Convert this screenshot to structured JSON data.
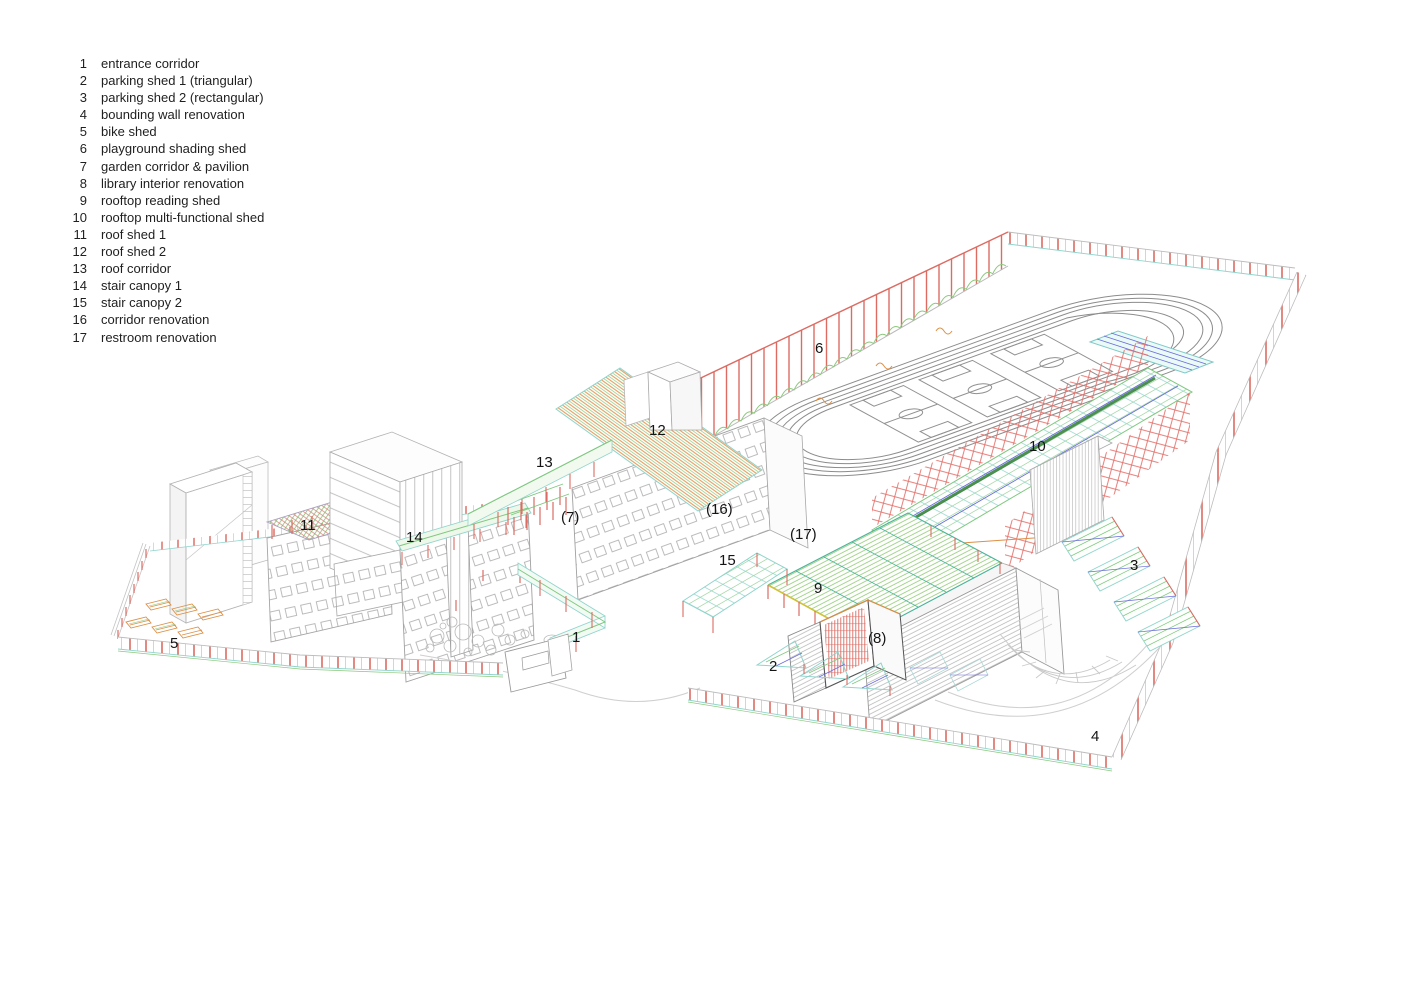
{
  "legend": {
    "items": [
      {
        "num": "1",
        "label": "entrance corridor"
      },
      {
        "num": "2",
        "label": "parking shed 1 (triangular)"
      },
      {
        "num": "3",
        "label": "parking shed 2 (rectangular)"
      },
      {
        "num": "4",
        "label": "bounding wall renovation"
      },
      {
        "num": "5",
        "label": "bike shed"
      },
      {
        "num": "6",
        "label": "playground shading shed"
      },
      {
        "num": "7",
        "label": "garden corridor & pavilion"
      },
      {
        "num": "8",
        "label": "library interior renovation"
      },
      {
        "num": "9",
        "label": "rooftop reading shed"
      },
      {
        "num": "10",
        "label": "rooftop multi-functional shed"
      },
      {
        "num": "11",
        "label": "roof shed 1"
      },
      {
        "num": "12",
        "label": "roof shed 2"
      },
      {
        "num": "13",
        "label": "roof corridor"
      },
      {
        "num": "14",
        "label": "stair canopy 1"
      },
      {
        "num": "15",
        "label": "stair canopy 2"
      },
      {
        "num": "16",
        "label": "corridor renovation"
      },
      {
        "num": "17",
        "label": "restroom renovation"
      }
    ]
  },
  "drawing": {
    "labels": [
      {
        "text": "6"
      },
      {
        "text": "12"
      },
      {
        "text": "13"
      },
      {
        "text": "10"
      },
      {
        "text": "(16)"
      },
      {
        "text": "(7)"
      },
      {
        "text": "(17)"
      },
      {
        "text": "11"
      },
      {
        "text": "14"
      },
      {
        "text": "15"
      },
      {
        "text": "3"
      },
      {
        "text": "9"
      },
      {
        "text": "1"
      },
      {
        "text": "(8)"
      },
      {
        "text": "5"
      },
      {
        "text": "2"
      },
      {
        "text": "4"
      }
    ]
  },
  "colors": {
    "red": "#dd6b62",
    "truss_red": "#e2706a",
    "green": "#7fc87f",
    "light_green": "#90cc74",
    "cyan": "#8fd4cc",
    "teal": "#49b39b",
    "orange": "#dd8f45",
    "blue": "#6b6bdc",
    "yellow": "#cfc23a",
    "dark_green": "#2e7d33",
    "line_gray": "#b9b9b9",
    "text": "#141414"
  }
}
